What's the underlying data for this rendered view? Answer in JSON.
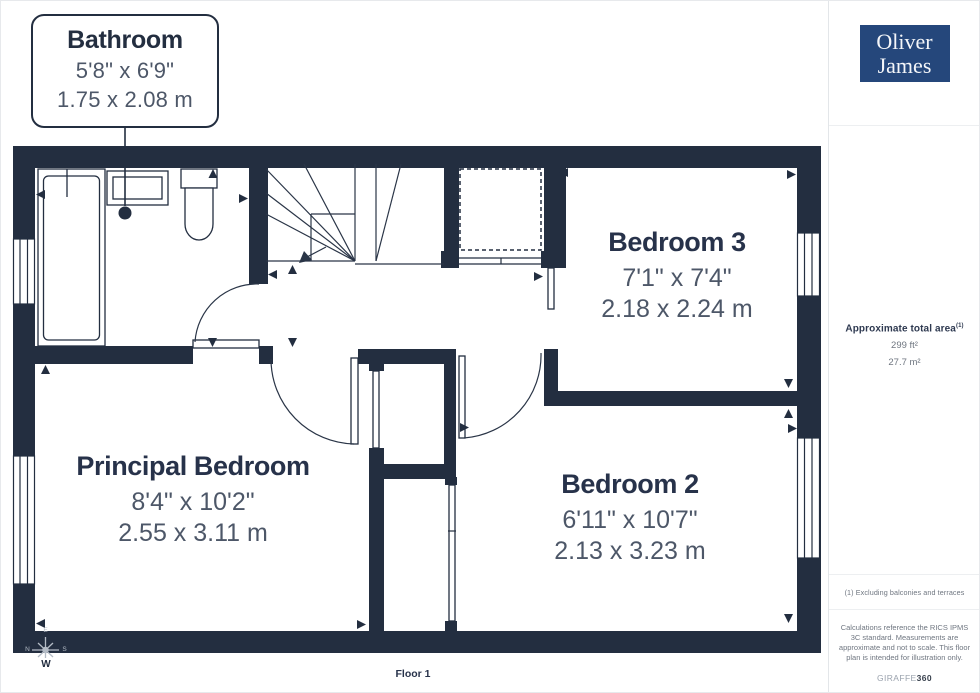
{
  "callout": {
    "title": "Bathroom",
    "imperial": "5'8\" x 6'9\"",
    "metric": "1.75 x 2.08 m"
  },
  "rooms": [
    {
      "name": "Bedroom 3",
      "imperial": "7'1\" x 7'4\"",
      "metric": "2.18 x 2.24 m"
    },
    {
      "name": "Principal Bedroom",
      "imperial": "8'4\" x 10'2\"",
      "metric": "2.55 x 3.11 m"
    },
    {
      "name": "Bedroom 2",
      "imperial": "6'11\" x 10'7\"",
      "metric": "2.13 x 3.23 m"
    }
  ],
  "floor_label": "Floor 1",
  "compass": {
    "n": "N",
    "e": "E",
    "s": "S",
    "w": "W"
  },
  "sidebar": {
    "logo": {
      "line1": "Oliver",
      "line2": "James"
    },
    "area": {
      "title": "Approximate total area",
      "superscript": "(1)",
      "imperial": "299 ft²",
      "metric": "27.7 m²"
    },
    "footnote": "(1) Excluding balconies and terraces",
    "disclaimer": "Calculations reference the RICS IPMS 3C standard. Measurements are approximate and not to scale. This floor plan is intended for illustration only.",
    "brand": {
      "name": "GIRAFFE",
      "suffix": "360"
    }
  },
  "colors": {
    "wall": "#232e40",
    "room_name_text": "#27324a",
    "dimension_text": "#4d5768",
    "muted_text": "#6f7680",
    "logo_background": "#25477b",
    "compass_light": "#b4bcc6"
  }
}
